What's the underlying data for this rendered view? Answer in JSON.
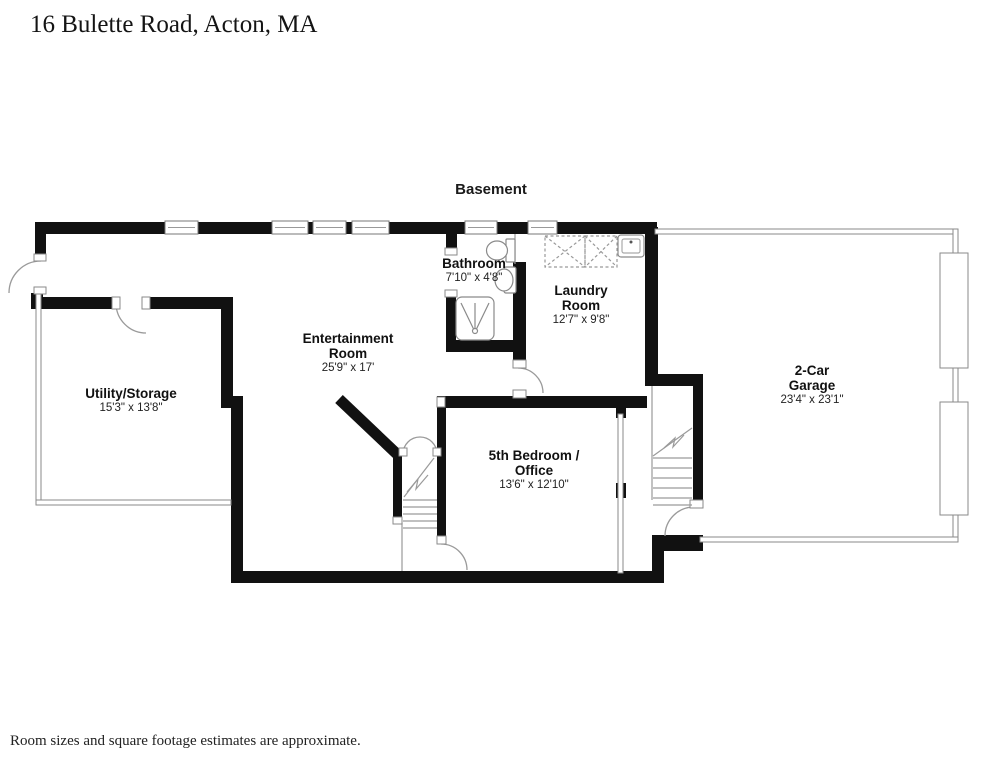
{
  "title": "16 Bulette Road, Acton, MA",
  "floor_label": "Basement",
  "footnote": "Room sizes and square footage estimates are approximate.",
  "rooms": [
    {
      "name": "Utility/Storage",
      "dims": "15'3\" x 13'8\""
    },
    {
      "name": "Entertainment",
      "name2": "Room",
      "dims": "25'9\" x 17'"
    },
    {
      "name": "Bathroom",
      "dims": "7'10\" x 4'8\""
    },
    {
      "name": "Laundry",
      "name2": "Room",
      "dims": "12'7\" x 9'8\""
    },
    {
      "name": "5th Bedroom /",
      "name2": "Office",
      "dims": "13'6\" x 12'10\""
    },
    {
      "name": "2-Car",
      "name2": "Garage",
      "dims": "23'4\" x 23'1\""
    }
  ],
  "colors": {
    "wall": "#111111",
    "thin_wall_stroke": "#8a8a8a",
    "text": "#1a1a1a"
  }
}
